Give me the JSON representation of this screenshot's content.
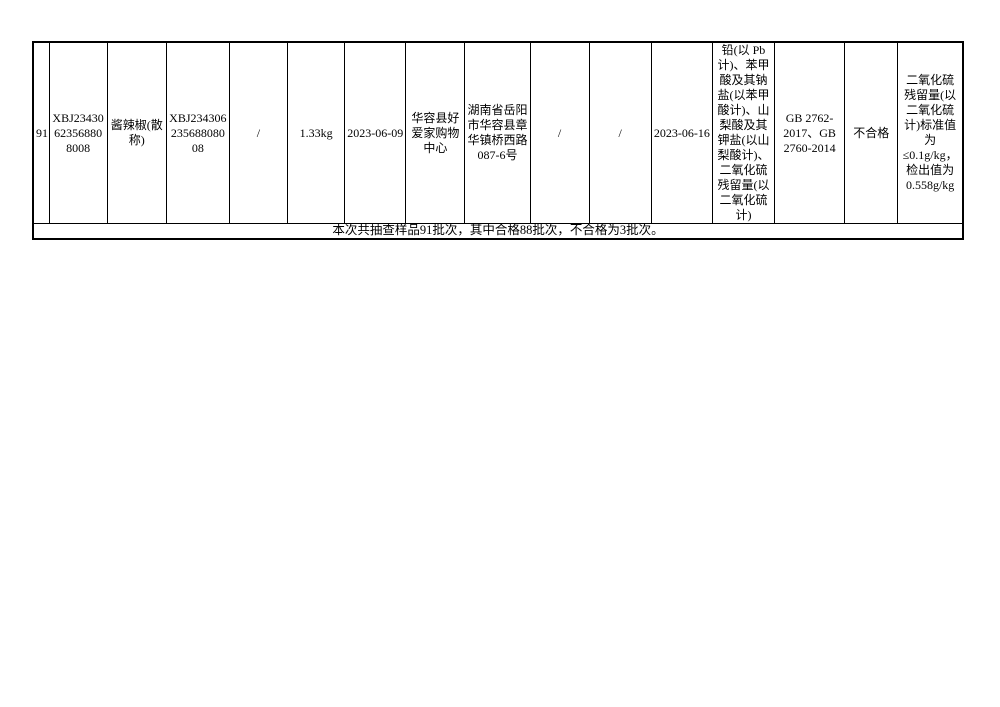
{
  "colors": {
    "highlight_red": "#ff0000",
    "text_black": "#000000",
    "border_black": "#000000",
    "page_background": "#ffffff"
  },
  "table": {
    "row": {
      "cells": [
        "91",
        "XBJ23430623568808008",
        "酱辣椒(散称)",
        "XBJ23430623568808008",
        "/",
        "1.33kg",
        "2023-06-09",
        "华容县好爱家购物中心",
        "湖南省岳阳市华容县章华镇桥西路087-6号",
        "/",
        "/",
        "2023-06-16",
        "铅(以 Pb 计)、苯甲酸及其钠盐(以苯甲酸计)、山梨酸及其钾盐(以山梨酸计)、二氧化硫残留量(以二氧化硫计)",
        "GB 2762-2017、GB 2760-2014",
        "不合格",
        "二氧化硫残留量(以二氧化硫计)标准值为≤0.1g/kg，检出值为0.558g/kg"
      ]
    },
    "summary": "本次共抽查样品91批次，其中合格88批次，不合格为3批次。"
  }
}
